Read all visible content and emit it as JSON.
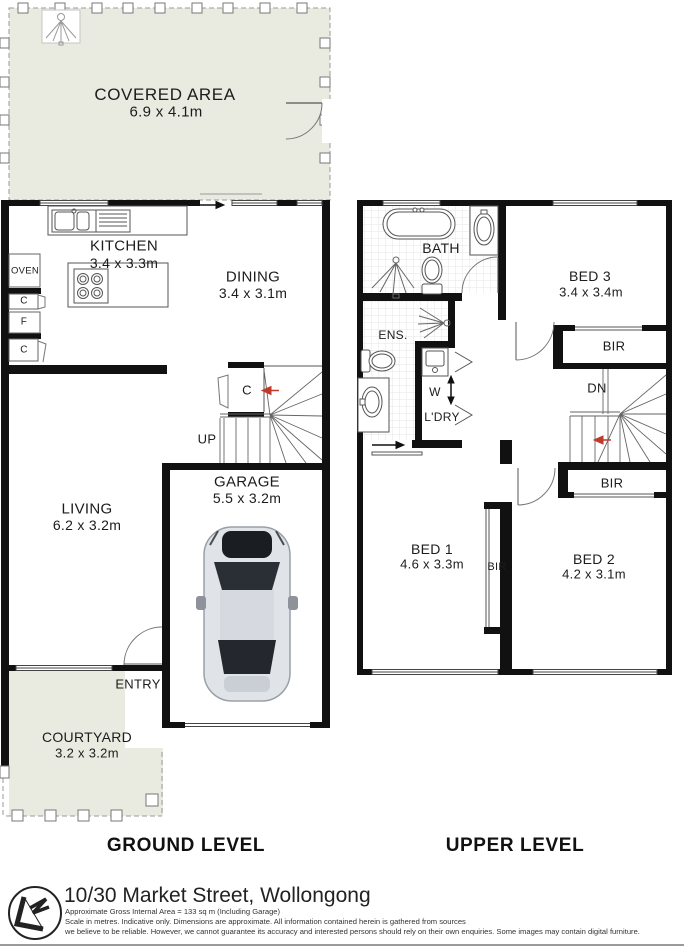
{
  "ground": {
    "title": "GROUND LEVEL",
    "covered_area": {
      "name": "COVERED AREA",
      "dims": "6.9 x 4.1m"
    },
    "kitchen": {
      "name": "KITCHEN",
      "dims": "3.4 x 3.3m"
    },
    "dining": {
      "name": "DINING",
      "dims": "3.4 x 3.1m"
    },
    "living": {
      "name": "LIVING",
      "dims": "6.2 x 3.2m"
    },
    "garage": {
      "name": "GARAGE",
      "dims": "5.5 x 3.2m"
    },
    "courtyard": {
      "name": "COURTYARD",
      "dims": "3.2 x 3.2m"
    },
    "labels": {
      "oven": "OVEN",
      "cupboard": "C",
      "fridge": "F",
      "up": "UP",
      "entry": "ENTRY"
    }
  },
  "upper": {
    "title": "UPPER LEVEL",
    "bath": {
      "name": "BATH"
    },
    "ens": {
      "name": "ENS."
    },
    "laundry": {
      "name": "L'DRY"
    },
    "washer": {
      "name": "W"
    },
    "bed1": {
      "name": "BED 1",
      "dims": "4.6 x 3.3m"
    },
    "bed2": {
      "name": "BED 2",
      "dims": "4.2 x 3.1m"
    },
    "bed3": {
      "name": "BED 3",
      "dims": "3.4 x 3.4m"
    },
    "labels": {
      "bir": "BIR",
      "dn": "DN"
    }
  },
  "footer": {
    "address": "10/30 Market Street, Wollongong",
    "area_note": "Approximate Gross Internal Area = 133 sq m (Including Garage)",
    "disclaimer_line1": "Scale in metres. Indicative only. Dimensions are approximate. All information contained herein is gathered from sources",
    "disclaimer_line2": "we believe to be reliable. However, we cannot guarantee its accuracy and interested persons should rely on their own enquiries. Some images may contain digital furniture."
  },
  "colors": {
    "outdoor_fill": "#e9ebe1",
    "wall": "#111111",
    "stair_arrow": "#c0392b",
    "tile_line": "#e4e4e4"
  }
}
